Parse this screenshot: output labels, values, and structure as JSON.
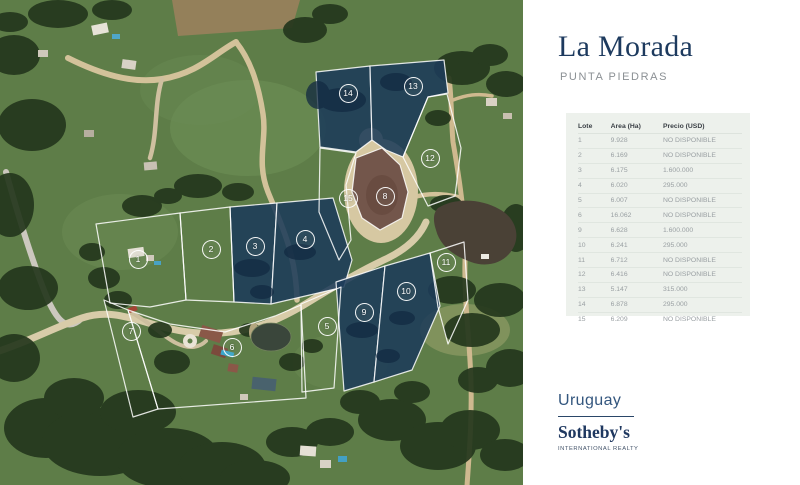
{
  "panel": {
    "title": "La Morada",
    "subtitle": "PUNTA PIEDRAS",
    "table": {
      "columns": [
        "Lote",
        "Area (Ha)",
        "Precio (USD)"
      ],
      "rows": [
        {
          "lote": "1",
          "area": "9.928",
          "precio": "NO DISPONIBLE"
        },
        {
          "lote": "2",
          "area": "6.169",
          "precio": "NO DISPONIBLE"
        },
        {
          "lote": "3",
          "area": "6.175",
          "precio": "1.600.000"
        },
        {
          "lote": "4",
          "area": "6.020",
          "precio": "295.000"
        },
        {
          "lote": "5",
          "area": "6.007",
          "precio": "NO DISPONIBLE"
        },
        {
          "lote": "6",
          "area": "16.062",
          "precio": "NO DISPONIBLE"
        },
        {
          "lote": "9",
          "area": "6.628",
          "precio": "1.600.000"
        },
        {
          "lote": "10",
          "area": "6.241",
          "precio": "295.000"
        },
        {
          "lote": "11",
          "area": "6.712",
          "precio": "NO DISPONIBLE"
        },
        {
          "lote": "12",
          "area": "6.416",
          "precio": "NO DISPONIBLE"
        },
        {
          "lote": "13",
          "area": "5.147",
          "precio": "315.000"
        },
        {
          "lote": "14",
          "area": "6.878",
          "precio": "295.000"
        },
        {
          "lote": "15",
          "area": "6.209",
          "precio": "NO DISPONIBLE"
        }
      ]
    },
    "brand": {
      "region": "Uruguay",
      "name": "Sotheby's",
      "tagline": "INTERNATIONAL REALTY"
    }
  },
  "map": {
    "markers": [
      {
        "label": "1",
        "x": 138,
        "y": 259,
        "overlay": false
      },
      {
        "label": "2",
        "x": 211,
        "y": 249,
        "overlay": false
      },
      {
        "label": "3",
        "x": 255,
        "y": 246,
        "overlay": true
      },
      {
        "label": "4",
        "x": 305,
        "y": 239,
        "overlay": true
      },
      {
        "label": "5",
        "x": 327,
        "y": 326,
        "overlay": false
      },
      {
        "label": "6",
        "x": 232,
        "y": 347,
        "overlay": false
      },
      {
        "label": "7",
        "x": 131,
        "y": 331,
        "overlay": false
      },
      {
        "label": "8",
        "x": 385,
        "y": 196,
        "overlay": false
      },
      {
        "label": "9",
        "x": 364,
        "y": 312,
        "overlay": true
      },
      {
        "label": "10",
        "x": 406,
        "y": 291,
        "overlay": true
      },
      {
        "label": "11",
        "x": 446,
        "y": 262,
        "overlay": false
      },
      {
        "label": "12",
        "x": 430,
        "y": 158,
        "overlay": false
      },
      {
        "label": "13",
        "x": 413,
        "y": 86,
        "overlay": true
      },
      {
        "label": "14",
        "x": 348,
        "y": 93,
        "overlay": true
      },
      {
        "label": "15",
        "x": 348,
        "y": 198,
        "overlay": false
      }
    ],
    "colors": {
      "overlay_navy": "#1c3b59",
      "boundary_white": "#ffffff",
      "field_green": "#5e7d48"
    }
  },
  "theme": {
    "accent_navy": "#1d3a5e",
    "table_bg": "#edf1ec",
    "subtitle_gray": "#8b9094"
  }
}
